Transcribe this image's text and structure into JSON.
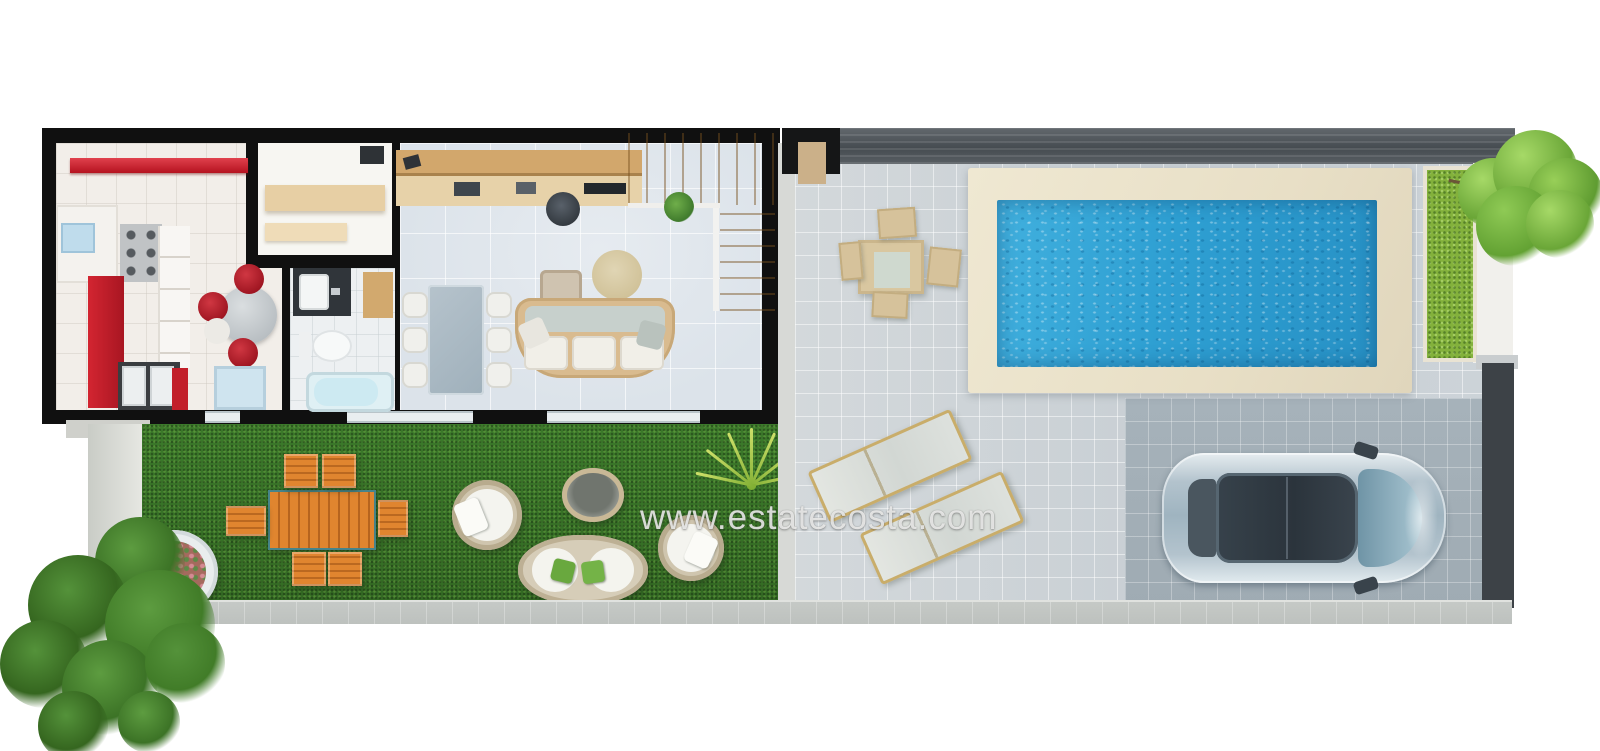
{
  "watermark": {
    "text": "www.estatecosta.com"
  },
  "scene": {
    "type": "3d-floor-plan-top-view",
    "areas": [
      "kitchen",
      "storage-closet",
      "bathroom",
      "living-dining-room",
      "staircase",
      "garden-lawn",
      "pool-terrace",
      "swimming-pool",
      "driveway",
      "planter-strip"
    ],
    "furniture": [
      "kitchen-red-counter",
      "stove",
      "round-kitchen-table",
      "washing-machines",
      "bathroom-vanity",
      "toilet",
      "bathtub",
      "desk",
      "office-chair",
      "glass-dining-table",
      "sofa",
      "ottoman",
      "round-rug",
      "orange-garden-table",
      "orange-garden-chairs",
      "flower-pot",
      "rattan-armchairs",
      "rattan-loveseat",
      "rattan-coffee-table",
      "outdoor-dining-set",
      "sun-loungers",
      "silver-car",
      "trees"
    ]
  },
  "colors": {
    "wall": "#101010",
    "kitchen_floor": "#f2eee9",
    "living_floor": "#dce3ea",
    "grass": "#3c7a2b",
    "patio": "#ccd3d8",
    "driveway": "#9fabb3",
    "pool_water": "#2e9fd2",
    "pool_deck": "#e8dfc6",
    "red": "#c6202c",
    "wood": "#d2a76c",
    "orange": "#e0852f",
    "fence": "#464c51",
    "planter": "#83b13c",
    "walkway": "#c6cac7",
    "car": "#b3c3cd"
  }
}
